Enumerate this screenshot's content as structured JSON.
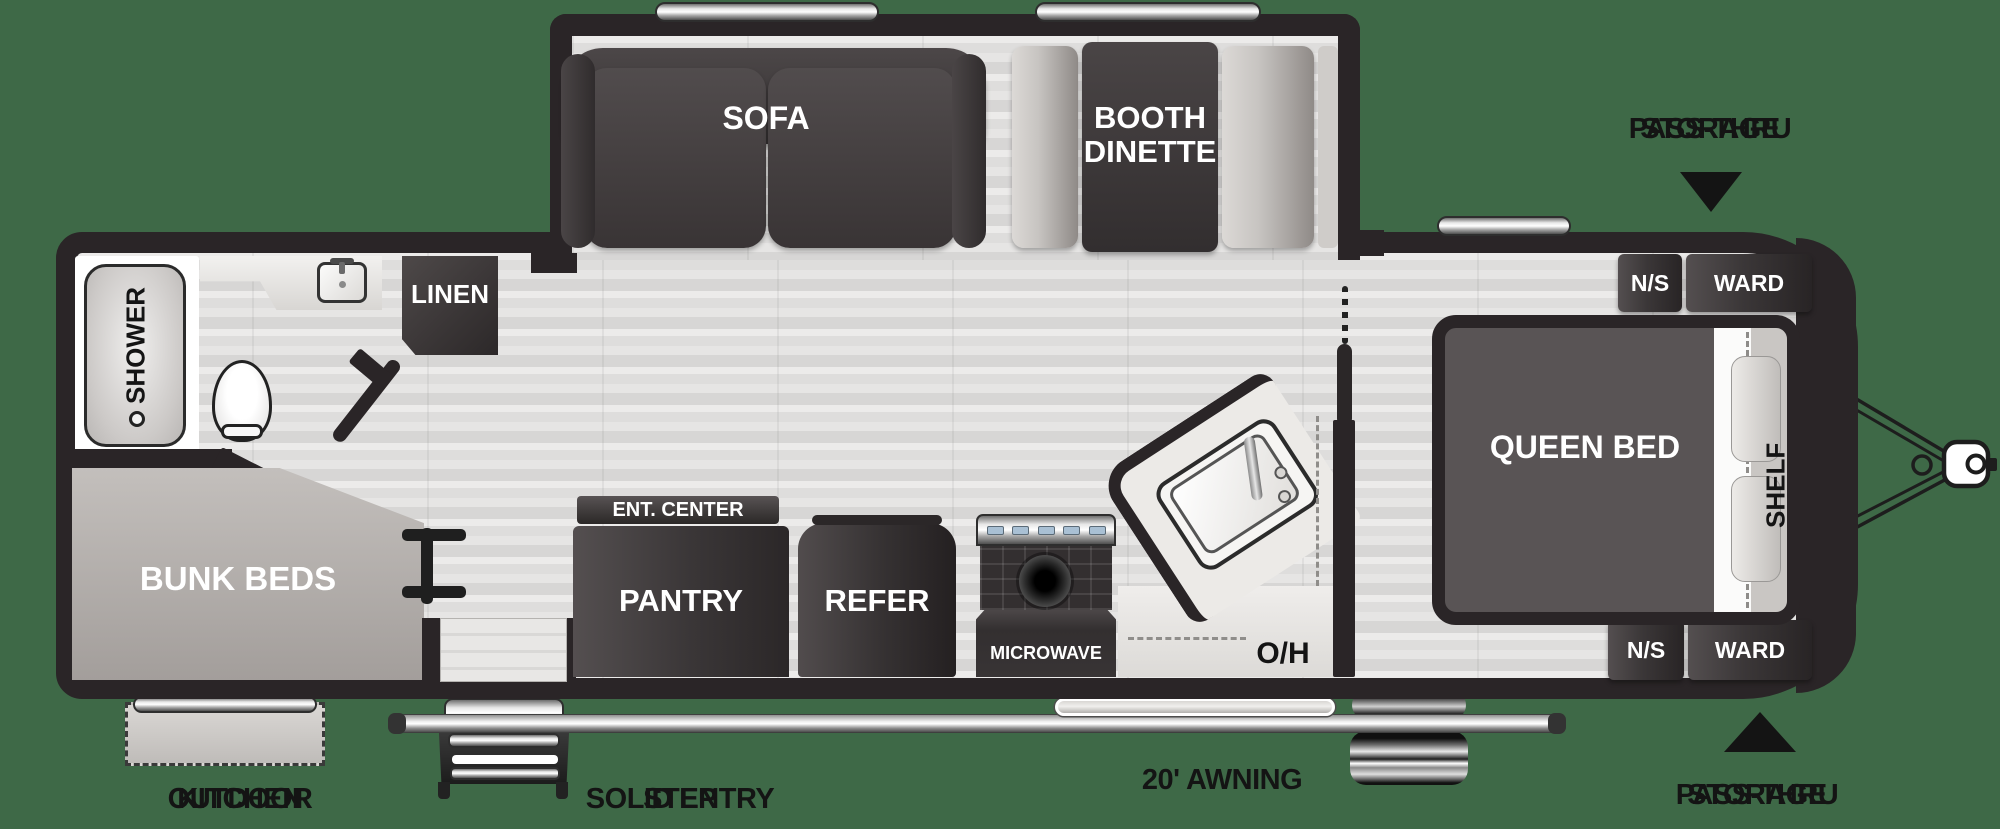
{
  "colors": {
    "bg": "#3e6947",
    "wall": "#2a2527",
    "ink": "#141414",
    "floor": "#e2e1e0",
    "dark-furniture": "#3b3738",
    "light-bench": "#c7c4c1",
    "bunk-gray": "#b3aeac",
    "counter": "#eceae7"
  },
  "exterior_labels": {
    "pass_thru_top": [
      "PASS-THRU",
      "STORAGE"
    ],
    "pass_thru_bottom": [
      "PASS-THRU",
      "STORAGE"
    ],
    "outdoor_kitchen": [
      "OUTDOOR",
      "KITCHEN"
    ],
    "solid_entry_step": [
      "SOLID ENTRY",
      "STEP"
    ],
    "awning": "20' AWNING"
  },
  "interior_labels": {
    "sofa": "SOFA",
    "booth_dinette": [
      "BOOTH",
      "DINETTE"
    ],
    "linen": "LINEN",
    "shower": "SHOWER",
    "bunk_beds": "BUNK BEDS",
    "ent_center": "ENT. CENTER",
    "pantry": "PANTRY",
    "refer": "REFER",
    "microwave": "MICROWAVE",
    "overhead": "O/H",
    "queen_bed": "QUEEN BED",
    "shelf": "SHELF",
    "nightstand_top": "N/S",
    "wardrobe_top": "WARD",
    "nightstand_bottom": "N/S",
    "wardrobe_bottom": "WARD"
  }
}
